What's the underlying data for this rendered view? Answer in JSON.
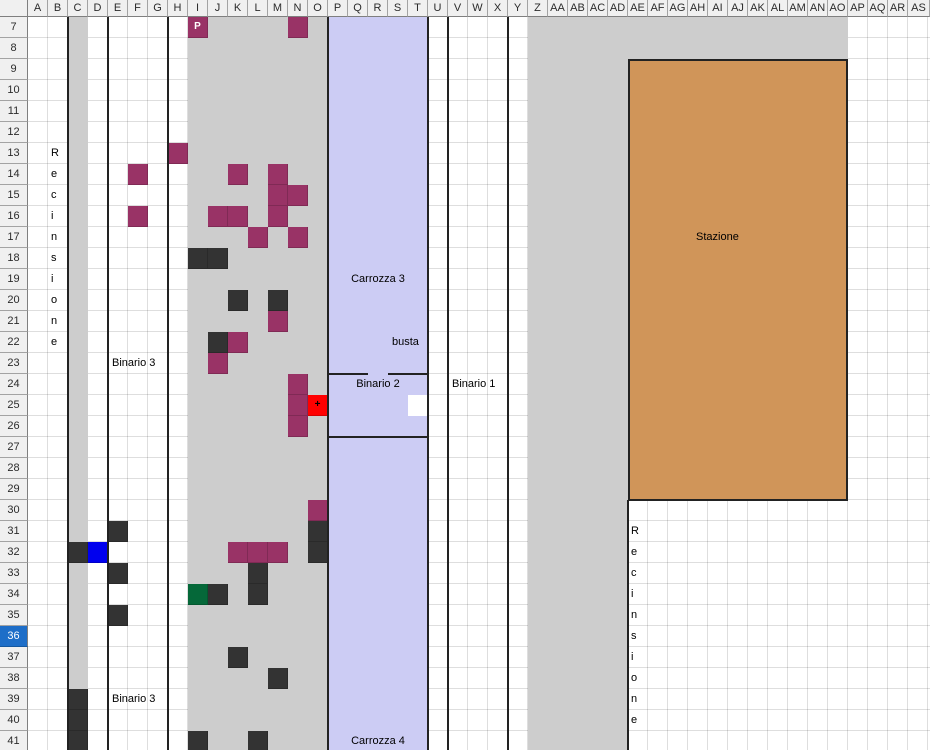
{
  "palette": {
    "gray_region": "#cdcdcd",
    "lavender": "#ccccf4",
    "orange": "#d09559",
    "plum": "#993366",
    "dark": "#333333",
    "blue": "#0000ee",
    "red": "#ff0000",
    "green": "#056839",
    "white": "#ffffff",
    "line": "#222222",
    "selected_row_header": "#1e6ec8"
  },
  "sheet": {
    "columns": [
      "A",
      "B",
      "C",
      "D",
      "E",
      "F",
      "G",
      "H",
      "I",
      "J",
      "K",
      "L",
      "M",
      "N",
      "O",
      "P",
      "Q",
      "R",
      "S",
      "T",
      "U",
      "V",
      "W",
      "X",
      "Y",
      "Z",
      "AA",
      "AB",
      "AC",
      "AD",
      "AE",
      "AF",
      "AG",
      "AH",
      "AI",
      "AJ",
      "AK",
      "AL",
      "AM",
      "AN",
      "AO",
      "AP",
      "AQ",
      "AR",
      "AS"
    ],
    "first_row": 7,
    "last_row": 41,
    "selected_row": 36
  },
  "regions": [
    {
      "name": "column-c-strip",
      "from_col": "C",
      "to_col": "C",
      "from_row": 7,
      "to_row": 41,
      "fill": "gray_region",
      "grid": "dark"
    },
    {
      "name": "yard-left",
      "from_col": "I",
      "to_col": "O",
      "from_row": 7,
      "to_row": 41,
      "fill": "gray_region",
      "grid": "dark"
    },
    {
      "name": "carriage-corridor",
      "from_col": "P",
      "to_col": "T",
      "from_row": 7,
      "to_row": 41,
      "fill": "lavender",
      "grid": "dark"
    },
    {
      "name": "yard-right-top",
      "from_col": "Z",
      "to_col": "AO",
      "from_row": 7,
      "to_row": 8,
      "fill": "gray_region",
      "grid": "dark"
    },
    {
      "name": "yard-right",
      "from_col": "Z",
      "to_col": "AD",
      "from_row": 9,
      "to_row": 41,
      "fill": "gray_region",
      "grid": "dark"
    },
    {
      "name": "station",
      "from_col": "AE",
      "to_col": "AO",
      "from_row": 9,
      "to_row": 29,
      "fill": "orange",
      "grid": "light",
      "border": true
    },
    {
      "name": "corridor-opening",
      "from_col": "T",
      "to_col": "T",
      "from_row": 25,
      "to_row": 25,
      "fill": "white"
    }
  ],
  "cells": [
    {
      "c": "I",
      "r": 7,
      "color": "plum",
      "label": "P",
      "label_color": "#ffffff"
    },
    {
      "c": "N",
      "r": 7,
      "color": "plum"
    },
    {
      "c": "H",
      "r": 13,
      "color": "plum"
    },
    {
      "c": "F",
      "r": 14,
      "color": "plum"
    },
    {
      "c": "K",
      "r": 14,
      "color": "plum"
    },
    {
      "c": "M",
      "r": 14,
      "color": "plum"
    },
    {
      "c": "M",
      "r": 15,
      "color": "plum"
    },
    {
      "c": "N",
      "r": 15,
      "color": "plum"
    },
    {
      "c": "F",
      "r": 16,
      "color": "plum"
    },
    {
      "c": "J",
      "r": 16,
      "color": "plum"
    },
    {
      "c": "K",
      "r": 16,
      "color": "plum"
    },
    {
      "c": "M",
      "r": 16,
      "color": "plum"
    },
    {
      "c": "L",
      "r": 17,
      "color": "plum"
    },
    {
      "c": "N",
      "r": 17,
      "color": "plum"
    },
    {
      "c": "I",
      "r": 18,
      "color": "dark"
    },
    {
      "c": "J",
      "r": 18,
      "color": "dark"
    },
    {
      "c": "K",
      "r": 20,
      "color": "dark"
    },
    {
      "c": "M",
      "r": 20,
      "color": "dark"
    },
    {
      "c": "M",
      "r": 21,
      "color": "plum"
    },
    {
      "c": "J",
      "r": 22,
      "color": "dark"
    },
    {
      "c": "K",
      "r": 22,
      "color": "plum"
    },
    {
      "c": "J",
      "r": 23,
      "color": "plum"
    },
    {
      "c": "N",
      "r": 24,
      "color": "plum"
    },
    {
      "c": "N",
      "r": 25,
      "color": "plum"
    },
    {
      "c": "O",
      "r": 25,
      "color": "red",
      "label": "+",
      "label_color": "#000000"
    },
    {
      "c": "N",
      "r": 26,
      "color": "plum"
    },
    {
      "c": "O",
      "r": 30,
      "color": "plum"
    },
    {
      "c": "E",
      "r": 31,
      "color": "dark"
    },
    {
      "c": "O",
      "r": 31,
      "color": "dark"
    },
    {
      "c": "C",
      "r": 32,
      "color": "dark"
    },
    {
      "c": "D",
      "r": 32,
      "color": "blue"
    },
    {
      "c": "K",
      "r": 32,
      "color": "plum"
    },
    {
      "c": "L",
      "r": 32,
      "color": "plum"
    },
    {
      "c": "M",
      "r": 32,
      "color": "plum"
    },
    {
      "c": "O",
      "r": 32,
      "color": "dark"
    },
    {
      "c": "E",
      "r": 33,
      "color": "dark"
    },
    {
      "c": "L",
      "r": 33,
      "color": "dark"
    },
    {
      "c": "I",
      "r": 34,
      "color": "green"
    },
    {
      "c": "J",
      "r": 34,
      "color": "dark"
    },
    {
      "c": "L",
      "r": 34,
      "color": "dark"
    },
    {
      "c": "E",
      "r": 35,
      "color": "dark"
    },
    {
      "c": "K",
      "r": 37,
      "color": "dark"
    },
    {
      "c": "M",
      "r": 38,
      "color": "dark"
    },
    {
      "c": "C",
      "r": 39,
      "color": "dark"
    },
    {
      "c": "C",
      "r": 40,
      "color": "dark"
    },
    {
      "c": "C",
      "r": 41,
      "color": "dark"
    },
    {
      "c": "I",
      "r": 41,
      "color": "dark"
    },
    {
      "c": "L",
      "r": 41,
      "color": "dark"
    }
  ],
  "lines": {
    "vertical_full": [
      {
        "name": "fence-line-left",
        "after_col": "B"
      },
      {
        "name": "track3-line-left",
        "after_col": "D"
      },
      {
        "name": "track3-line-right",
        "after_col": "G"
      },
      {
        "name": "corridor-border-left",
        "after_col": "O"
      },
      {
        "name": "corridor-border-right",
        "after_col": "T"
      },
      {
        "name": "track1-line-left",
        "after_col": "U"
      },
      {
        "name": "track1-line-right",
        "after_col": "X"
      }
    ],
    "vertical_partial": [
      {
        "name": "fence-line-right",
        "after_col": "AD",
        "from_row": 30,
        "to_row": 41
      }
    ],
    "horizontal": [
      {
        "name": "busta-top-left",
        "below_row": 23,
        "from_col": "P",
        "to_col": "Q"
      },
      {
        "name": "busta-top-right",
        "below_row": 23,
        "from_col": "S",
        "to_col": "T"
      },
      {
        "name": "busta-bottom",
        "below_row": 26,
        "from_col": "P",
        "to_col": "T"
      }
    ]
  },
  "labels": [
    {
      "name": "recinsione-left",
      "text": "Recinsione",
      "orientation": "vertical-letters",
      "col": "B",
      "start_row": 13
    },
    {
      "name": "binario-3-upper",
      "text": "Binario 3",
      "col": "E",
      "row": 23,
      "align": "left"
    },
    {
      "name": "carrozza-3",
      "text": "Carrozza 3",
      "row": 19,
      "span_from": "P",
      "span_to": "T",
      "align": "center"
    },
    {
      "name": "busta",
      "text": "busta",
      "col": "S",
      "row": 22,
      "align": "left"
    },
    {
      "name": "binario-2",
      "text": "Binario 2",
      "row": 24,
      "span_from": "P",
      "span_to": "T",
      "align": "center"
    },
    {
      "name": "binario-1",
      "text": "Binario 1",
      "col": "V",
      "row": 24,
      "align": "left"
    },
    {
      "name": "stazione",
      "text": "Stazione",
      "col": "AH",
      "row": 17,
      "align": "left"
    },
    {
      "name": "binario-3-lower",
      "text": "Binario 3",
      "col": "E",
      "row": 39,
      "align": "left"
    },
    {
      "name": "carrozza-4",
      "text": "Carrozza 4",
      "row": 41,
      "span_from": "P",
      "span_to": "T",
      "align": "center"
    },
    {
      "name": "recinsione-right",
      "text": "Recinsione",
      "orientation": "vertical-letters",
      "col": "AE",
      "start_row": 31
    }
  ]
}
